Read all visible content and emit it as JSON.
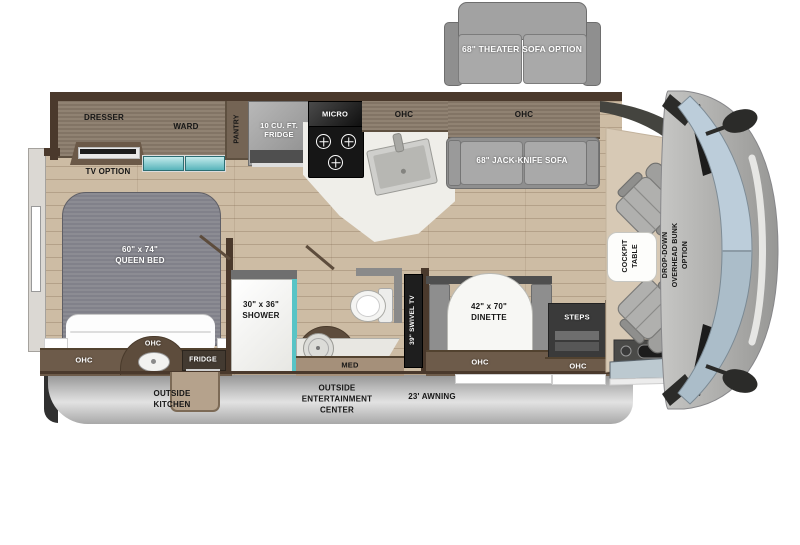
{
  "title": "Class C motorhome floor plan (top view)",
  "palette": {
    "floor_wood": "#cdbca4",
    "floor_line": "#7a624a",
    "wall_dark_brown": "#4a392c",
    "cabinet_brown": "#6d5b4a",
    "overhead_wood": "#8a7b6b",
    "furniture_gray": "#9a9a9a",
    "mattress_gray": "#85858c",
    "teal_accent": "#58c4c6",
    "counter_white": "#efeee9",
    "skirt_gray": "#c9c9c9",
    "windshield_blue": "#bccdda",
    "cab_body_gray": "#aaaaa8",
    "label_black": "#161616",
    "label_white": "#ffffff"
  },
  "labels": {
    "theater_sofa_option": "68\" THEATER SOFA OPTION",
    "dresser": "DRESSER",
    "ward": "WARD",
    "pantry": "PANTRY",
    "kitchen_fridge": "10 CU. FT.\nFRIDGE",
    "micro": "MICRO",
    "ohc": "OHC",
    "jack_knife_sofa": "68\" JACK-KNIFE SOFA",
    "tv_option": "TV OPTION",
    "queen_bed": "60\" x 74\"\nQUEEN BED",
    "bed_fridge": "FRIDGE",
    "outside_kitchen": "OUTSIDE\nKITCHEN",
    "shower": "30\" x 36\"\nSHOWER",
    "med": "MED",
    "swivel_tv": "39\" SWIVEL TV",
    "dinette": "42\" x 70\"\nDINETTE",
    "steps": "STEPS",
    "outside_entertainment_center": "OUTSIDE\nENTERTAINMENT\nCENTER",
    "awning": "23' AWNING",
    "cockpit_table": "COCKPIT\nTABLE",
    "drop_down_bunk": "DROP-DOWN\nOVERHEAD BUNK\nOPTION"
  }
}
